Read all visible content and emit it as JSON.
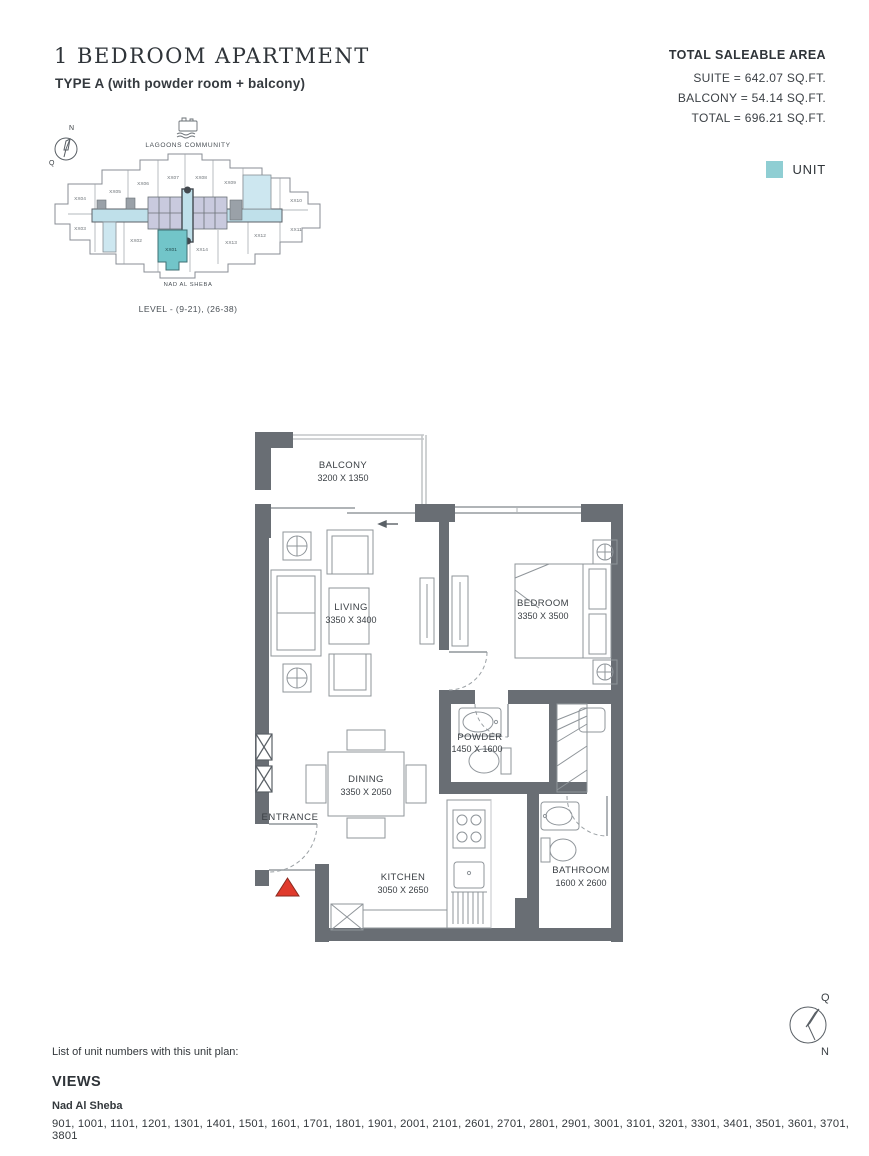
{
  "header": {
    "title": "1 BEDROOM APARTMENT",
    "subtitle": "TYPE A (with powder room + balcony)",
    "area": {
      "heading": "TOTAL SALEABLE AREA",
      "suite": "SUITE = 642.07 SQ.FT.",
      "balcony": "BALCONY = 54.14 SQ.FT.",
      "total": "TOTAL = 696.21 SQ.FT."
    }
  },
  "legend": {
    "label": "UNIT",
    "color": "#8fced3"
  },
  "keyplan": {
    "community_label": "LAGOONS COMMUNITY",
    "bottom_label": "NAD AL SHEBA",
    "level_label": "LEVEL - (9-21), (26-38)",
    "highlighted_unit": "XX01",
    "units": [
      "XX01",
      "XX02",
      "XX03",
      "XX04",
      "XX05",
      "XX06",
      "XX07",
      "XX08",
      "XX09",
      "XX10",
      "XX11",
      "XX12",
      "XX13",
      "XX14"
    ],
    "compass": {
      "north": "N",
      "q": "Q"
    }
  },
  "floorplan": {
    "rooms": [
      {
        "name": "BALCONY",
        "dims": "3200 X 1350"
      },
      {
        "name": "LIVING",
        "dims": "3350 X 3400"
      },
      {
        "name": "BEDROOM",
        "dims": "3350 X 3500"
      },
      {
        "name": "POWDER",
        "dims": "1450 X 1600"
      },
      {
        "name": "DINING",
        "dims": "3350 X 2050"
      },
      {
        "name": "KITCHEN",
        "dims": "3050 X 2650"
      },
      {
        "name": "BATHROOM",
        "dims": "1600 X 2600"
      }
    ],
    "entrance_label": "ENTRANCE"
  },
  "compass_bottom": {
    "q": "Q",
    "n": "N"
  },
  "footer": {
    "list_label": "List of unit numbers with this unit plan:",
    "views_heading": "VIEWS",
    "view_name": "Nad Al Sheba",
    "unit_numbers": "901, 1001, 1101, 1201, 1301, 1401, 1501, 1601, 1701, 1801, 1901, 2001, 2101, 2601, 2701, 2801, 2901, 3001, 3101, 3201, 3301, 3401, 3501, 3601, 3701, 3801"
  },
  "colors": {
    "wall": "#696e74",
    "unit_highlight": "#72c5c9",
    "corridor": "#bfe0ea",
    "core": "#c9cade",
    "entrance_marker": "#e03a2c"
  }
}
